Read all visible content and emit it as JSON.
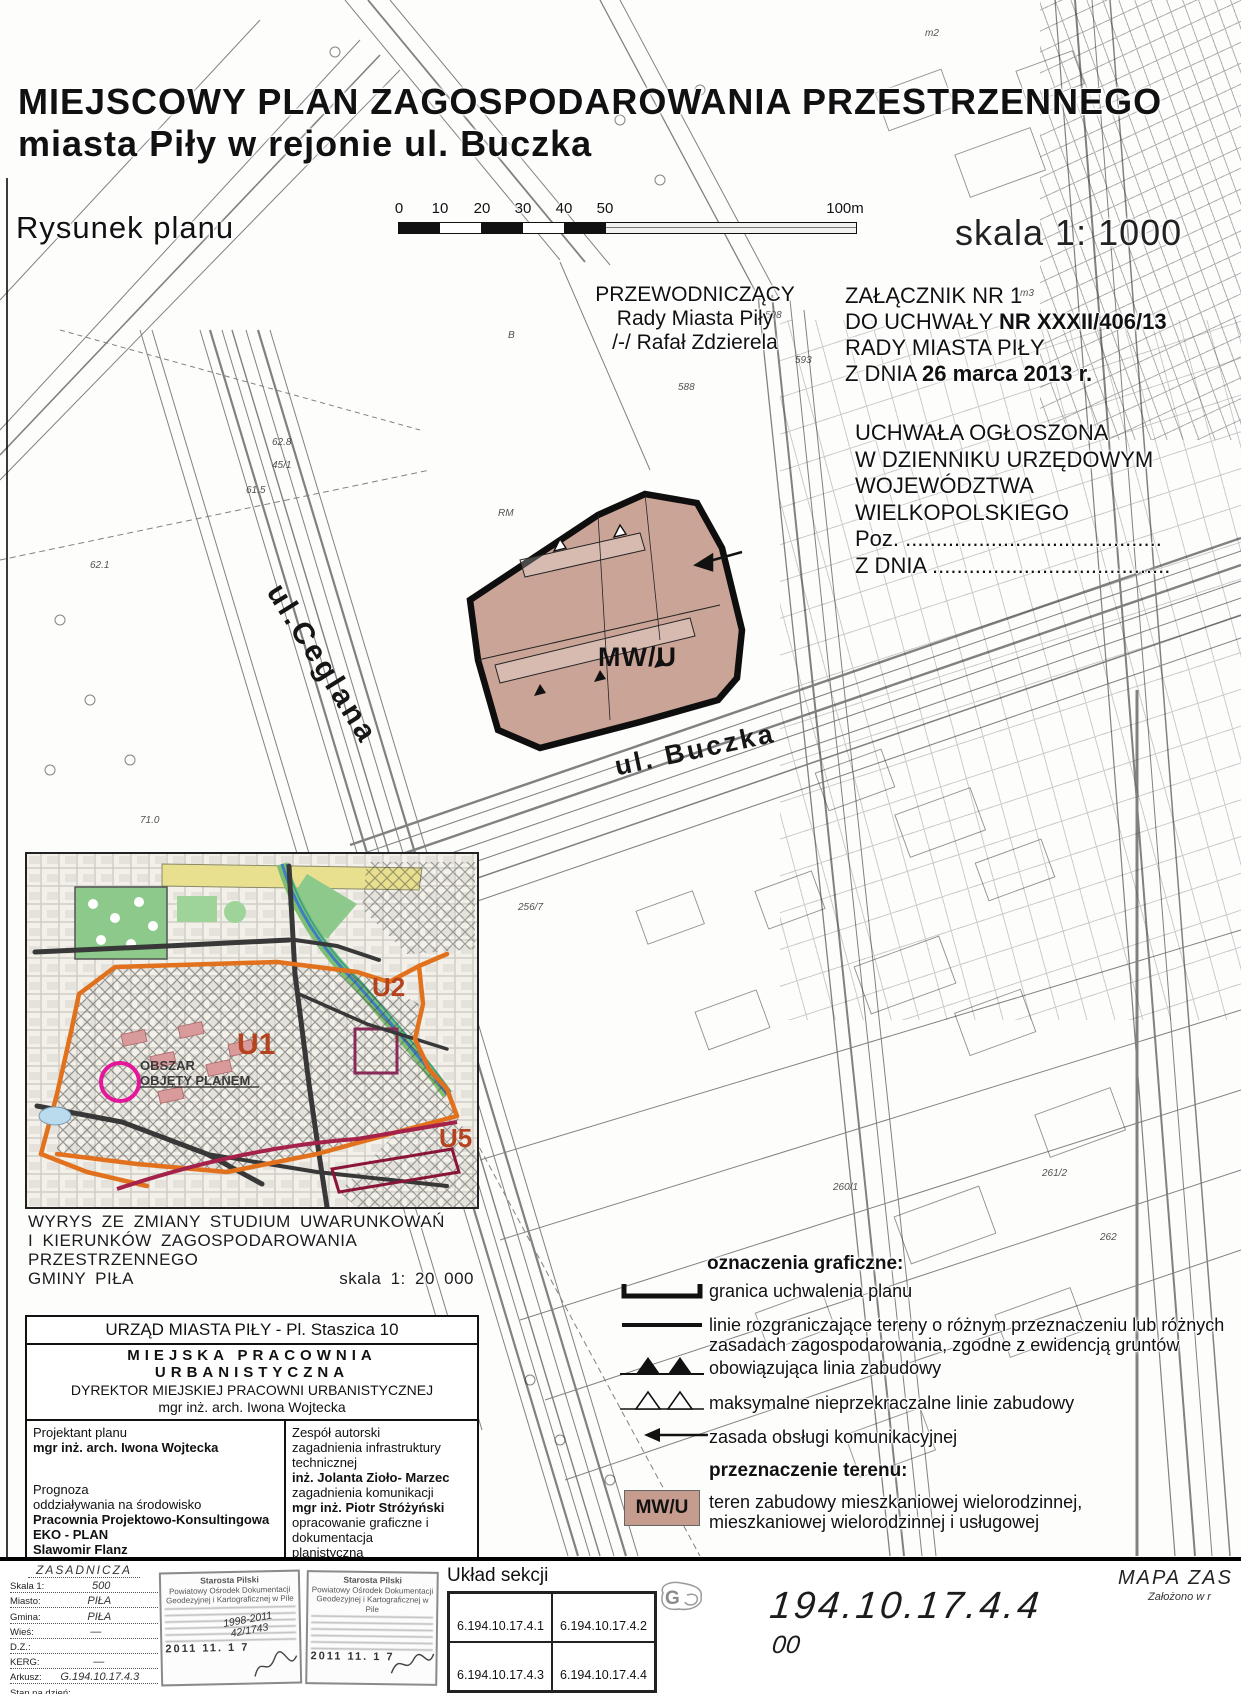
{
  "doc": {
    "title_line1": "MIEJSCOWY PLAN ZAGOSPODAROWANIA PRZESTRZENNEGO",
    "title_line2": "miasta  Piły w rejonie ul. Buczka",
    "drawing_label": "Rysunek planu",
    "scale_label": "skala 1: 1000"
  },
  "scalebar": {
    "ticks": [
      "0",
      "10",
      "20",
      "30",
      "40",
      "50"
    ],
    "end_label": "100m"
  },
  "chairman": {
    "line1": "PRZEWODNICZĄCY",
    "line2": "Rady Miasta Piły",
    "line3": "/-/ Rafał Zdzierela"
  },
  "attachment": {
    "line1": "ZAŁĄCZNIK NR 1",
    "line2_prefix": "DO UCHWAŁY ",
    "line2_bold": "NR XXXII/406/13",
    "line3": "RADY MIASTA PIŁY",
    "line4_prefix": "Z DNIA ",
    "line4_bold": "26 marca 2013 r."
  },
  "announcement": {
    "line1": "UCHWAŁA OGŁOSZONA",
    "line2": "W DZIENNIKU URZĘDOWYM",
    "line3": "WOJEWÓDZTWA",
    "line4": "WIELKOPOLSKIEGO",
    "line5": "Poz. ..........................................",
    "line6": "Z DNIA ......................................."
  },
  "map": {
    "zone_label": "MW/U",
    "street1": "ul.Ceglana",
    "street2": "ul. Buczka",
    "zone_fill": "#c69c8e",
    "spots": [
      {
        "label": "61.5",
        "x": 246,
        "y": 485
      },
      {
        "label": "62.8",
        "x": 272,
        "y": 437
      },
      {
        "label": "45/1",
        "x": 272,
        "y": 460
      },
      {
        "label": "62.1",
        "x": 90,
        "y": 560
      },
      {
        "label": "588",
        "x": 678,
        "y": 382
      },
      {
        "label": "593",
        "x": 795,
        "y": 355
      },
      {
        "label": "598",
        "x": 765,
        "y": 310
      },
      {
        "label": "m2",
        "x": 925,
        "y": 28
      },
      {
        "label": "m3",
        "x": 1020,
        "y": 288
      },
      {
        "label": "B",
        "x": 508,
        "y": 330
      },
      {
        "label": "260/1",
        "x": 833,
        "y": 1182
      },
      {
        "label": "261/2",
        "x": 1042,
        "y": 1168
      },
      {
        "label": "262",
        "x": 1100,
        "y": 1232
      },
      {
        "label": "256/7",
        "x": 518,
        "y": 902
      },
      {
        "label": "71.0",
        "x": 140,
        "y": 815
      },
      {
        "label": "RM",
        "x": 498,
        "y": 508
      }
    ]
  },
  "inset": {
    "u1": "U1",
    "u2": "U2",
    "u5": "U5",
    "area_line1": "OBSZAR",
    "area_line2": "OBJĘTY PLANEM",
    "caption_line1": "WYRYS ZE ZMIANY STUDIUM UWARUNKOWAŃ",
    "caption_line2": "I KIERUNKÓW ZAGOSPODAROWANIA PRZESTRZENNEGO",
    "caption_line3": "GMINY PIŁA",
    "caption_scale": "skala 1: 20 000"
  },
  "office": {
    "header": "URZĄD MIASTA PIŁY - Pl. Staszica 10",
    "studio": "MIEJSKA PRACOWNIA URBANISTYCZNA",
    "director_title": "DYREKTOR MIEJSKIEJ PRACOWNI URBANISTYCZNEJ",
    "director_name": "mgr inż. arch. Iwona Wojtecka",
    "left": {
      "role1": "Projektant planu",
      "name1": "mgr inż. arch. Iwona Wojtecka",
      "role2_line1": "Prognoza",
      "role2_line2": "oddziaływania na środowisko",
      "name2_line1": "Pracownia Projektowo-Konsultingowa",
      "name2_line2": "EKO - PLAN",
      "name2_line3": "Slawomir Flanz"
    },
    "right": {
      "header": "Zespół autorski",
      "r1": "zagadnienia infrastruktury technicznej",
      "n1": "inż. Jolanta Zioło- Marzec",
      "r2": "zagadnienia komunikacji",
      "n2": "mgr inż. Piotr  Stróżyński",
      "r3a": "opracowanie graficzne i dokumentacja",
      "r3b": "planistyczna",
      "n3": "tech. Danuta Nowakowska",
      "r4": "Procedura formalno-prawna",
      "n4": "mgr Krystyna Syguła"
    }
  },
  "legend": {
    "header": "oznaczenia graficzne:",
    "item1": "granica uchwalenia planu",
    "item2_line1": "linie rozgraniczające tereny o różnym przeznaczeniu lub różnych",
    "item2_line2": "zasadach zagospodarowania, zgodne z ewidencją gruntów",
    "item3": "obowiązująca linia zabudowy",
    "item4": "maksymalne nieprzekraczalne linie zabudowy",
    "item5": "zasada obsługi komunikacyjnej",
    "dest_header": "przeznaczenie terenu:",
    "dest_code": "MW/U",
    "dest_line1": "teren zabudowy mieszkaniowej wielorodzinnej,",
    "dest_line2": "mieszkaniowej wielorodzinnej i usługowej",
    "zone_fill": "#c69c8e"
  },
  "footer": {
    "form": {
      "type_value": "ZASADNICZA",
      "rows": [
        {
          "label": "Skala 1:",
          "value": "500"
        },
        {
          "label": "Miasto:",
          "value": "PIŁA"
        },
        {
          "label": "Gmina:",
          "value": "PIŁA"
        },
        {
          "label": "Wieś:",
          "value": "—"
        },
        {
          "label": "D.Z.:",
          "value": ""
        },
        {
          "label": "KERG:",
          "value": "—"
        },
        {
          "label": "Arkusz:",
          "value": "G.194.10.17.4.3"
        },
        {
          "label": "Stan na dzień:",
          "value": ""
        }
      ]
    },
    "stamp1": {
      "line1": "Starosta Pilski",
      "line2": "Powiatowy Ośrodek Dokumentacji",
      "line3": "Geodezyjnej i Kartograficznej w Pile",
      "hand1": "1998-2011",
      "hand2": "42/1743",
      "date": "2011  11.  1 7"
    },
    "stamp2": {
      "line1": "Starosta Pilski",
      "line2": "Powiatowy Ośrodek Dokumentacji",
      "line3": "Geodezyjnej i Kartograficznej w Pile",
      "date": "2011  11.  1 7"
    },
    "uklad_label": "Układ sekcji",
    "sekcja": [
      "6.194.10.17.4.1",
      "6.194.10.17.4.2",
      "6.194.10.17.4.3",
      "6.194.10.17.4.4"
    ],
    "logo_letter": "G",
    "sheet_number": "194.10.17.4.4",
    "sheet_sub": "00",
    "map_type": "MAPA  ZAS",
    "map_note": "Założono w r"
  }
}
